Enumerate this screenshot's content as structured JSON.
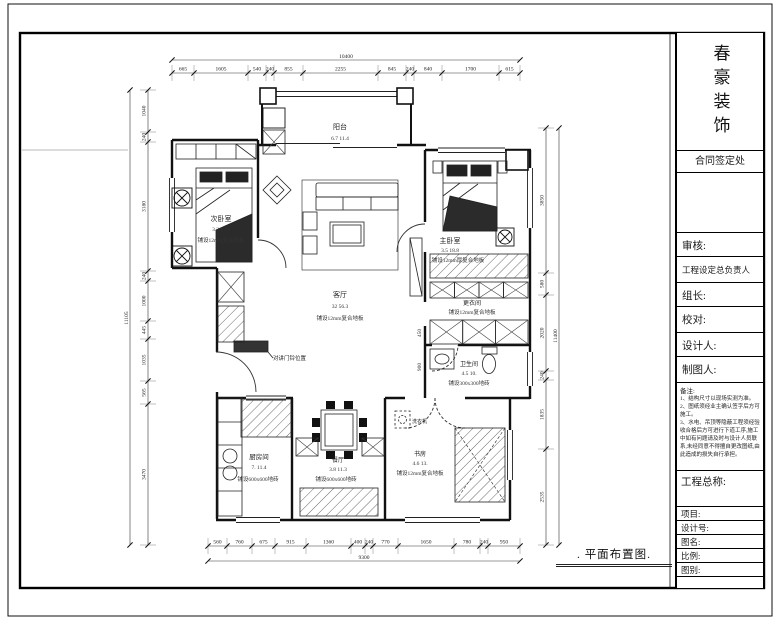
{
  "sheet": {
    "plan_title": ". 平面布置图."
  },
  "title_block": {
    "company": "春豪装饰",
    "contract_label": "合同签定处",
    "fields": [
      {
        "label": "审核:"
      },
      {
        "label": "工程设定总负责人"
      },
      {
        "label": "组长:"
      },
      {
        "label": "校对:"
      },
      {
        "label": "设计人:"
      },
      {
        "label": "制图人:"
      }
    ],
    "notes_title": "备注:",
    "notes": [
      "1、结构尺寸以现场实测为准。",
      "2、图纸须经业主确认签字后方可施工。",
      "3、水电、吊顶等隐蔽工程须经验收合格后方可进行下道工序,施工中如有问题请及时与设计人员联系,未经同意不得擅自更改图纸,由此造成的损失自行承担。"
    ],
    "project_label": "工程总称:",
    "bottom_fields": [
      {
        "label": "项目:"
      },
      {
        "label": "设计号:"
      },
      {
        "label": "图名:"
      },
      {
        "label": "比例:"
      },
      {
        "label": "图别:"
      }
    ]
  },
  "plan": {
    "rooms": [
      {
        "name": "阳台",
        "nums": "6.7  11.4",
        "floor": ""
      },
      {
        "name": "次卧室",
        "nums": "3.2  17.8",
        "floor": "铺设12mm复合地板"
      },
      {
        "name": "客厅",
        "nums": "32  56.3",
        "floor": "铺设12mm复合地板"
      },
      {
        "name": "主卧室",
        "nums": "3.5  18.8",
        "floor": "铺设12mm厚复合地板"
      },
      {
        "name": "更衣间",
        "nums": "",
        "floor": "铺设12mm复合地板"
      },
      {
        "name": "卫生间",
        "nums": "4.5  10.",
        "floor": "铺设300x300地砖"
      },
      {
        "name": "厨房间",
        "nums": "7.  11.4",
        "floor": "铺设600x600地砖"
      },
      {
        "name": "餐厅",
        "nums": "3.8  11.3",
        "floor": "铺设600x600地砖"
      },
      {
        "name": "书房",
        "nums": "4.6  13.",
        "floor": "铺设12mm复合地板"
      }
    ],
    "annotations": {
      "intercom": "对讲门铃位置",
      "washer": "洗衣机"
    },
    "small_dims": [
      "900",
      "450"
    ]
  },
  "dims": {
    "top": {
      "total": "10400",
      "segments": [
        "665",
        "1605",
        "540",
        "240",
        "855",
        "2255",
        "845",
        "240",
        "840",
        "1700",
        "615"
      ]
    },
    "bottom": {
      "total": "9300",
      "segments": [
        "560",
        "760",
        "675",
        "915",
        "1360",
        "400",
        "240",
        "770",
        "1650",
        "780",
        "240",
        "950"
      ]
    },
    "left": {
      "total": "11105",
      "segments": [
        "1040",
        "240",
        "3180",
        "240",
        "1000",
        "445",
        "1035",
        "565",
        "3470"
      ]
    },
    "right": {
      "total": "11400",
      "segments": [
        "3850",
        "580",
        "2020",
        "240",
        "1835",
        "2535"
      ]
    }
  }
}
